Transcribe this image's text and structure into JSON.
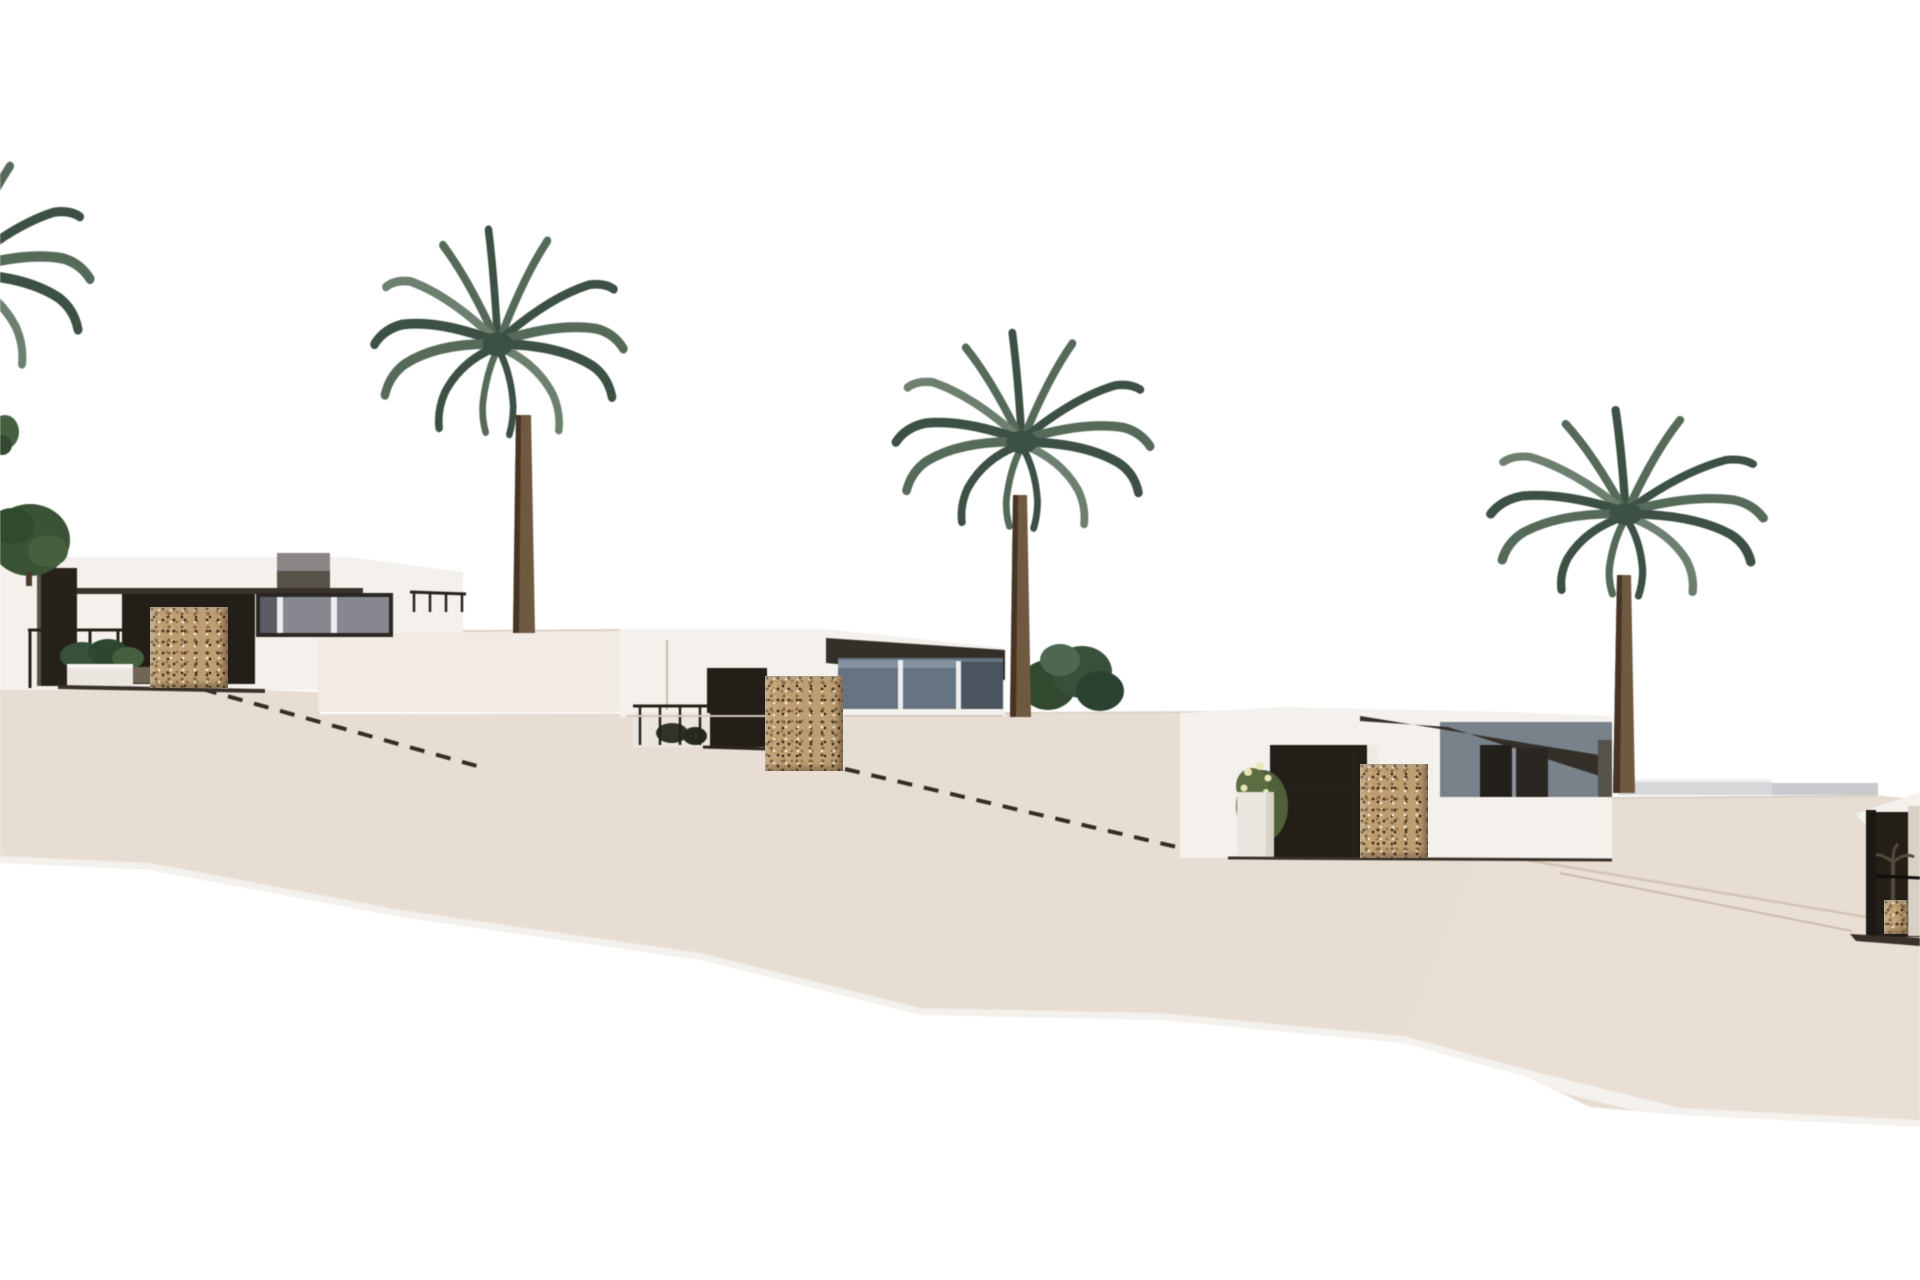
{
  "scene": {
    "kind": "architectural exterior 3D render",
    "setting": "row of white flat-roof villas stepping down a sandy hillside from left to right, white sky background",
    "villas": [
      {
        "id": 1,
        "position": "far left, highest terrace",
        "features": [
          "flat white roof",
          "rooftop stair box",
          "dark soffit band",
          "dark terrace opening",
          "speckled stone mosaic pillar",
          "dark corner pillar",
          "framed glass window",
          "metal railings",
          "white planter with shrubs",
          "small round tree"
        ]
      },
      {
        "id": 2,
        "position": "center-left, middle terrace",
        "features": [
          "sloping dark fascia",
          "blue-gray glass curtain wall",
          "dark terrace opening",
          "speckled stone mosaic pillar",
          "railing with dark planter"
        ]
      },
      {
        "id": 3,
        "position": "center-right, lower terrace",
        "features": [
          "dark fascia shadow band",
          "dark terrace opening",
          "speckled stone mosaic pillar",
          "white planter",
          "flowering shrub",
          "railing",
          "two dark windows in gray wall"
        ]
      },
      {
        "id": 4,
        "position": "far right edge, partially cropped",
        "features": [
          "angled white parapet",
          "dark shaded patio",
          "railing",
          "small stone pillar"
        ]
      }
    ],
    "palm_trees": [
      {
        "id": 1,
        "position": "far left edge",
        "note": "crown only partially visible"
      },
      {
        "id": 2,
        "position": "left-center",
        "note": "tallest palm, trunk lands on upper deck"
      },
      {
        "id": 3,
        "position": "center-right",
        "note": "trunk lands on middle plateau"
      },
      {
        "id": 4,
        "position": "right",
        "note": "trunk lands on lower terrace"
      }
    ],
    "vegetation": [
      "dark green shrub right of center villa",
      "shrubs behind left railing",
      "tiny tuft at left edge"
    ],
    "terrain": "terraced sand slope descending left to right, two dashed expansion-joint lines, faint crease lines at right, white cut-off wedge along bottom edge",
    "horizon": "two low light-gray walls at right horizon"
  },
  "colors": {
    "sky": "#ffffff",
    "sand": "#e7ddd3",
    "sandLow": "#e9dfd5",
    "deckWall": "#f1ebe3",
    "villaWhite": "#f4f1ec",
    "villaShade": "#e6e0d7",
    "roofDark": "#343029",
    "soffit": "#3a332c",
    "openingDark": "#241e18",
    "openingInner": "#7e725f",
    "glassBlue": "#657383",
    "glassDeep": "#49545f",
    "glassPale": "#8593a1",
    "windowGlass": "#87holder",
    "glassGray": "#87878f",
    "mullion": "#eeeeee",
    "stoneBase": "#bd9e72",
    "stoneDark": "#5e472e",
    "stoneMid": "#8a6a46",
    "stoneLight": "#e6d6b6",
    "darkPillar": "#26211b",
    "railing": "#26211a",
    "palmDark": "#3d5044",
    "palmMid": "#566a5a",
    "palmLight": "#6d8070",
    "trunk": "#6f5940",
    "trunkDark": "#463524",
    "bushGreen": "#37503a",
    "treeGreen": "#3a5236",
    "flower": "#e9e5b8",
    "dashLine": "#352c22",
    "crease": "#d2c3b2",
    "horizonWall": "#d6d7d9",
    "horizonWall2": "#c9cacd",
    "planterWhite": "#ebe7e0",
    "shadowLine": "#3a3229"
  }
}
